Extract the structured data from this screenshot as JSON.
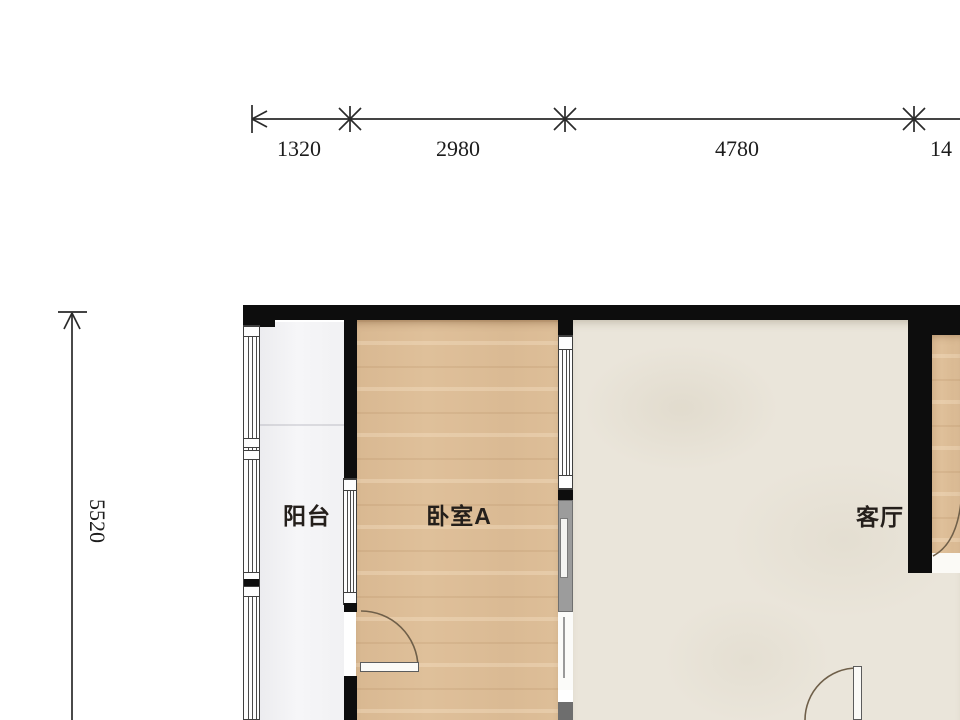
{
  "title": "apartment-floor-plan",
  "dimensions": {
    "top": [
      {
        "value": "1320"
      },
      {
        "value": "2980"
      },
      {
        "value": "4780"
      },
      {
        "value": "14"
      }
    ],
    "left": {
      "value": "5520"
    }
  },
  "rooms": {
    "balcony": {
      "label": "阳台"
    },
    "bedroom_a": {
      "label": "卧室A"
    },
    "living": {
      "label": "客厅"
    }
  },
  "symbols": {
    "door_swing_icon": "quarter-arc",
    "window_icon": "triple-glazing-lines",
    "dimension_tick_icon": "slash-cross",
    "dimension_arrow_icon": "open-arrowhead"
  },
  "colors": {
    "wall": "#0d0d0d",
    "wood": "#dfc09a",
    "tile": "#eae5da",
    "balcony": "#f3f3f5",
    "dim": "#2a2a2a",
    "door_arc": "#6f5f49"
  }
}
